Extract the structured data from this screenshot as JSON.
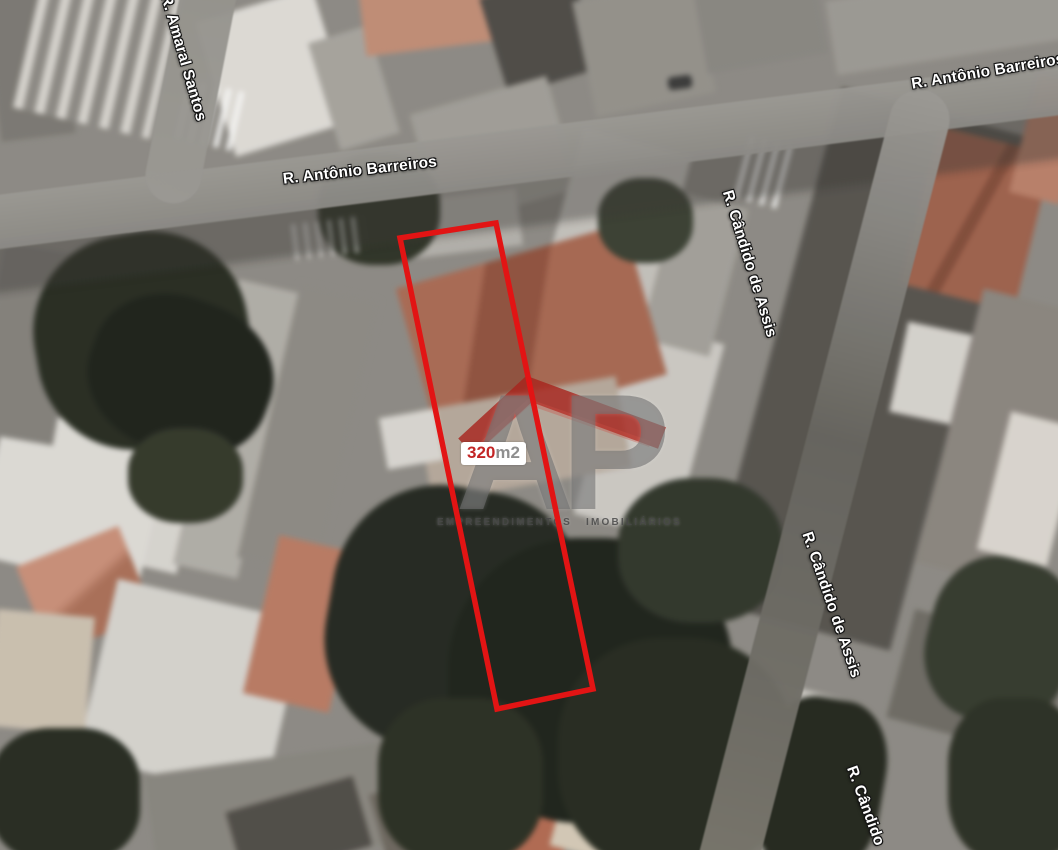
{
  "map": {
    "view_type": "satellite",
    "street_labels": [
      {
        "id": "amaral-santos",
        "text": "R. Amaral Santos"
      },
      {
        "id": "antonio-barreiros-left",
        "text": "R. Antônio Barreiros"
      },
      {
        "id": "antonio-barreiros-right",
        "text": "R. Antônio Barreiros"
      },
      {
        "id": "candido-de-assis-upper",
        "text": "R. Cândido de Assis"
      },
      {
        "id": "candido-de-assis-lower",
        "text": "R. Cândido de Assis"
      },
      {
        "id": "candido-bottom",
        "text": "R. Cândido"
      }
    ],
    "property": {
      "area_value": "320",
      "area_unit": "m2",
      "outline_color": "#e21414",
      "polygon_points": "400,238 496,223 593,689 497,709"
    },
    "watermark": {
      "letters": "AP",
      "tagline": "EMPREENDIMENTOS IMOBILIÁRIOS",
      "roof_color": "#a8231b",
      "letters_color": "#707070"
    },
    "colors": {
      "road": "#8e8c88",
      "roof_terracotta": "#a65f48",
      "roof_salmon": "#c78e75",
      "vegetation": "#232820",
      "building_light": "#dbd8d3",
      "label_text": "#ffffff"
    }
  }
}
